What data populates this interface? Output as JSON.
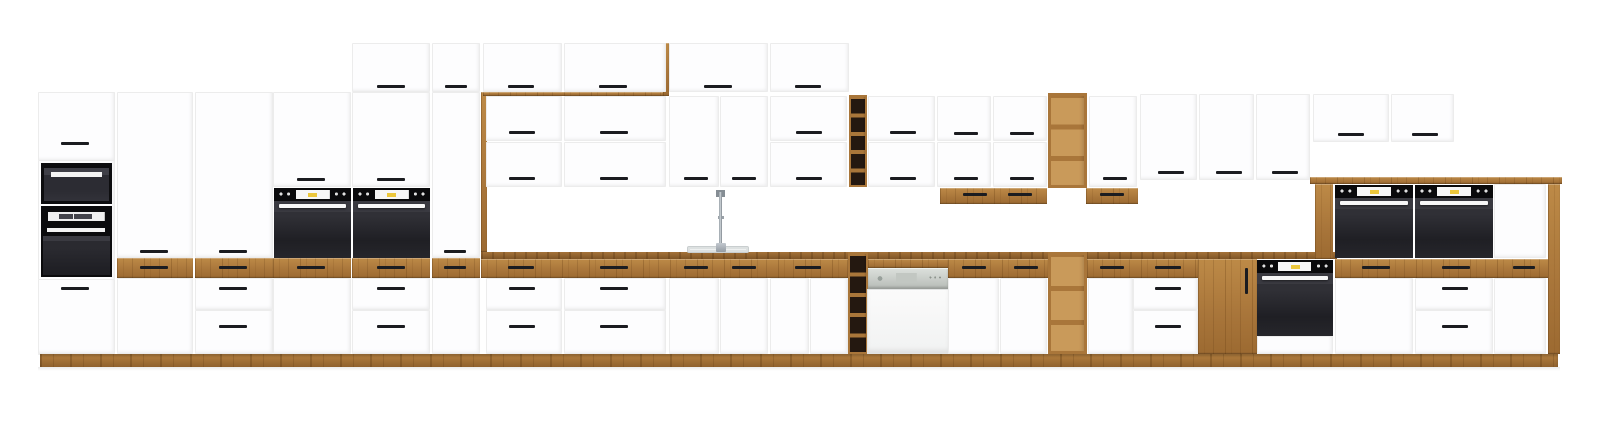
{
  "scene": {
    "width": 1600,
    "height": 434,
    "background": "#ffffff",
    "colors": {
      "cabinet_white": "#fdfdfe",
      "oak_wood": "#b07c3d",
      "oak_dark": "#7f5526",
      "handle_black": "#1b1c20",
      "oven_black": "#1f1f24",
      "accent_yellow": "#ecc73c",
      "dishwasher_gray": "#c7cbc7",
      "sink_gray": "#eff1f1"
    },
    "elements": [
      [
        "door",
        "tall-column-a-frame",
        38,
        92,
        77,
        263
      ],
      [
        "door",
        "tall-column-a-door-top",
        38,
        92,
        77,
        69
      ],
      [
        "h",
        "handle",
        61,
        142,
        28,
        3
      ],
      [
        "micro",
        "built-in-microwave",
        41,
        163,
        71,
        41
      ],
      [
        "oven-a",
        "built-in-oven-tall-column",
        41,
        206,
        71,
        71
      ],
      [
        "door",
        "tall-column-a-door-bottom",
        38,
        279,
        77,
        75
      ],
      [
        "h",
        "handle",
        61,
        287,
        28,
        3
      ],
      [
        "door",
        "tall-column-b-door",
        117,
        92,
        76,
        166
      ],
      [
        "h",
        "handle",
        140,
        250,
        28,
        3
      ],
      [
        "wood",
        "oak-drawer-front",
        117,
        258,
        76,
        20
      ],
      [
        "h",
        "handle",
        140,
        266,
        28,
        3
      ],
      [
        "door",
        "tall-column-b-base-panel",
        117,
        278,
        76,
        76
      ],
      [
        "door",
        "tall-column-c-door",
        195,
        92,
        78,
        166
      ],
      [
        "h",
        "handle",
        219,
        250,
        28,
        3
      ],
      [
        "wood",
        "oak-drawer-front",
        195,
        258,
        78,
        20
      ],
      [
        "h",
        "handle",
        219,
        266,
        28,
        3
      ],
      [
        "drawer",
        "drawer-front",
        195,
        278,
        78,
        32
      ],
      [
        "h",
        "handle",
        219,
        287,
        28,
        3
      ],
      [
        "drawer",
        "drawer-front",
        195,
        310,
        78,
        44
      ],
      [
        "h",
        "handle",
        219,
        325,
        28,
        3
      ],
      [
        "door",
        "oven-housing-d-door",
        273,
        92,
        78,
        95
      ],
      [
        "h",
        "handle",
        297,
        178,
        28,
        3
      ],
      [
        "oven",
        "built-in-oven-1",
        274,
        188,
        77,
        70
      ],
      [
        "wood",
        "oak-drawer-front",
        273,
        258,
        78,
        20
      ],
      [
        "h",
        "handle",
        297,
        266,
        28,
        3
      ],
      [
        "door",
        "oven-housing-d-base-door",
        273,
        278,
        78,
        76
      ],
      [
        "door",
        "oven-housing-e-top-door",
        352,
        43,
        78,
        49
      ],
      [
        "h",
        "handle",
        377,
        85,
        28,
        3
      ],
      [
        "door",
        "oven-housing-e-door",
        352,
        92,
        78,
        95
      ],
      [
        "h",
        "handle",
        377,
        178,
        28,
        3
      ],
      [
        "oven",
        "built-in-oven-2",
        353,
        188,
        77,
        70
      ],
      [
        "wood",
        "oak-drawer-front",
        352,
        258,
        78,
        20
      ],
      [
        "h",
        "handle",
        377,
        266,
        28,
        3
      ],
      [
        "drawer",
        "drawer-front",
        352,
        278,
        78,
        32
      ],
      [
        "h",
        "handle",
        377,
        287,
        28,
        3
      ],
      [
        "drawer",
        "drawer-front",
        352,
        310,
        78,
        44
      ],
      [
        "h",
        "handle",
        377,
        325,
        28,
        3
      ],
      [
        "door",
        "pantry-top-door",
        432,
        43,
        48,
        49
      ],
      [
        "h",
        "handle",
        445,
        85,
        22,
        3
      ],
      [
        "door",
        "pantry-tall-door",
        432,
        92,
        48,
        166
      ],
      [
        "h",
        "handle",
        444,
        250,
        22,
        3
      ],
      [
        "wood",
        "oak-drawer-front",
        432,
        258,
        48,
        20
      ],
      [
        "h",
        "handle",
        444,
        266,
        22,
        3
      ],
      [
        "door",
        "pantry-base-door",
        432,
        278,
        48,
        76
      ],
      [
        "wood",
        "oak-frame-left-post",
        481,
        92,
        6,
        160
      ],
      [
        "wood",
        "oak-frame-top-rail",
        483,
        92,
        180,
        4
      ],
      [
        "wood",
        "oak-frame-right-post",
        663,
        43,
        6,
        53
      ],
      [
        "door",
        "top-row-door",
        483,
        43,
        79,
        49
      ],
      [
        "h",
        "handle",
        508,
        85,
        26,
        3
      ],
      [
        "door",
        "top-row-door",
        564,
        43,
        102,
        49
      ],
      [
        "h",
        "handle",
        599,
        85,
        28,
        3
      ],
      [
        "door",
        "top-row-door",
        669,
        43,
        99,
        49
      ],
      [
        "h",
        "handle",
        704,
        85,
        28,
        3
      ],
      [
        "door",
        "top-row-door",
        770,
        43,
        79,
        49
      ],
      [
        "h",
        "handle",
        795,
        85,
        26,
        3
      ],
      [
        "door",
        "upper-cabinet-door",
        486,
        96,
        76,
        45
      ],
      [
        "h",
        "handle",
        509,
        131,
        26,
        3
      ],
      [
        "door",
        "upper-cabinet-door",
        486,
        142,
        76,
        45
      ],
      [
        "h",
        "handle",
        509,
        177,
        26,
        3
      ],
      [
        "door",
        "upper-cabinet-door",
        564,
        96,
        102,
        45
      ],
      [
        "h",
        "handle",
        600,
        131,
        28,
        3
      ],
      [
        "door",
        "upper-cabinet-door",
        564,
        142,
        102,
        45
      ],
      [
        "h",
        "handle",
        600,
        177,
        28,
        3
      ],
      [
        "door",
        "upper-cabinet-door",
        669,
        96,
        50,
        91
      ],
      [
        "h",
        "handle",
        684,
        177,
        24,
        3
      ],
      [
        "door",
        "upper-cabinet-door",
        720,
        96,
        48,
        91
      ],
      [
        "h",
        "handle",
        732,
        177,
        24,
        3
      ],
      [
        "door",
        "upper-cabinet-door",
        770,
        96,
        77,
        45
      ],
      [
        "h",
        "handle",
        796,
        131,
        26,
        3
      ],
      [
        "door",
        "upper-cabinet-door",
        770,
        142,
        77,
        45
      ],
      [
        "h",
        "handle",
        796,
        177,
        26,
        3
      ],
      [
        "wine",
        "wine-rack-upper",
        849,
        95,
        18,
        92
      ],
      [
        "door",
        "upper-cabinet-door",
        868,
        96,
        67,
        45
      ],
      [
        "h",
        "handle",
        890,
        131,
        26,
        3
      ],
      [
        "door",
        "upper-cabinet-door",
        868,
        142,
        67,
        45
      ],
      [
        "h",
        "handle",
        890,
        177,
        26,
        3
      ],
      [
        "door",
        "upper-cabinet-door",
        937,
        96,
        54,
        45
      ],
      [
        "h",
        "handle",
        954,
        132,
        24,
        3
      ],
      [
        "door",
        "upper-cabinet-door",
        937,
        142,
        54,
        45
      ],
      [
        "h",
        "handle",
        954,
        177,
        24,
        3
      ],
      [
        "door",
        "upper-cabinet-door",
        993,
        96,
        54,
        45
      ],
      [
        "h",
        "handle",
        1010,
        132,
        24,
        3
      ],
      [
        "door",
        "upper-cabinet-door",
        993,
        142,
        54,
        45
      ],
      [
        "h",
        "handle",
        1010,
        177,
        24,
        3
      ],
      [
        "wood",
        "oak-under-cabinet-drawers",
        940,
        188,
        107,
        16
      ],
      [
        "h",
        "handle",
        963,
        193,
        24,
        3
      ],
      [
        "h",
        "handle",
        1008,
        193,
        24,
        3
      ],
      [
        "shelf",
        "open-shelf-upper",
        1048,
        93,
        39,
        95
      ],
      [
        "door",
        "upper-cabinet-door",
        1089,
        96,
        48,
        91
      ],
      [
        "h",
        "handle",
        1103,
        177,
        24,
        3
      ],
      [
        "wood",
        "oak-under-cabinet-drawer",
        1086,
        188,
        52,
        16
      ],
      [
        "h",
        "handle",
        1100,
        193,
        24,
        3
      ],
      [
        "door",
        "upper-cabinet-door",
        1140,
        94,
        57,
        86
      ],
      [
        "h",
        "handle",
        1158,
        171,
        26,
        3
      ],
      [
        "door",
        "upper-cabinet-door",
        1199,
        94,
        55,
        86
      ],
      [
        "h",
        "handle",
        1216,
        171,
        26,
        3
      ],
      [
        "door",
        "upper-cabinet-door",
        1256,
        94,
        54,
        86
      ],
      [
        "h",
        "handle",
        1272,
        171,
        26,
        3
      ],
      [
        "door",
        "upper-cabinet-door-short",
        1313,
        94,
        76,
        48
      ],
      [
        "h",
        "handle",
        1338,
        133,
        26,
        3
      ],
      [
        "door",
        "upper-cabinet-door-short",
        1391,
        94,
        63,
        48
      ],
      [
        "h",
        "handle",
        1412,
        133,
        26,
        3
      ],
      [
        "wood-edge",
        "countertop-edge",
        481,
        252,
        856,
        7
      ],
      [
        "sink",
        "sink-basin",
        687,
        246,
        62,
        7
      ],
      [
        "faucet",
        "kitchen-faucet",
        712,
        190,
        18,
        62
      ],
      [
        "wood",
        "oak-drawer-band",
        481,
        259,
        367,
        19
      ],
      [
        "h",
        "handle",
        508,
        266,
        26,
        3
      ],
      [
        "h",
        "handle",
        600,
        266,
        28,
        3
      ],
      [
        "h",
        "handle",
        684,
        266,
        24,
        3
      ],
      [
        "h",
        "handle",
        732,
        266,
        24,
        3
      ],
      [
        "h",
        "handle",
        795,
        266,
        26,
        3
      ],
      [
        "wine-b",
        "wine-rack-base",
        848,
        252,
        20,
        102
      ],
      [
        "wood",
        "oak-drawer-band",
        868,
        259,
        80,
        9
      ],
      [
        "dw-panel",
        "dishwasher-control-panel",
        868,
        268,
        80,
        21
      ],
      [
        "dw-body",
        "dishwasher-door",
        867,
        289,
        82,
        65
      ],
      [
        "wood",
        "oak-drawer-band",
        948,
        259,
        100,
        19
      ],
      [
        "h",
        "handle",
        962,
        266,
        24,
        3
      ],
      [
        "h",
        "handle",
        1014,
        266,
        24,
        3
      ],
      [
        "shelf-b",
        "open-shelf-base",
        1048,
        252,
        39,
        102
      ],
      [
        "wood",
        "oak-drawer-band",
        1087,
        259,
        111,
        19
      ],
      [
        "h",
        "handle",
        1100,
        266,
        24,
        3
      ],
      [
        "h",
        "handle",
        1155,
        266,
        26,
        3
      ],
      [
        "wood",
        "oak-front-cabinet",
        1198,
        259,
        59,
        95
      ],
      [
        "vh",
        "vertical-handle",
        1245,
        268,
        3,
        26
      ],
      [
        "oven",
        "built-in-oven-base",
        1257,
        260,
        76,
        76
      ],
      [
        "door",
        "oven-base-drawer",
        1257,
        336,
        76,
        18
      ],
      [
        "drawer",
        "drawer-front",
        486,
        278,
        76,
        32
      ],
      [
        "h",
        "handle",
        509,
        287,
        26,
        3
      ],
      [
        "drawer",
        "drawer-front",
        486,
        310,
        76,
        44
      ],
      [
        "h",
        "handle",
        509,
        325,
        26,
        3
      ],
      [
        "drawer",
        "drawer-front",
        564,
        278,
        102,
        32
      ],
      [
        "h",
        "handle",
        600,
        287,
        28,
        3
      ],
      [
        "drawer",
        "drawer-front",
        564,
        310,
        102,
        44
      ],
      [
        "h",
        "handle",
        600,
        325,
        28,
        3
      ],
      [
        "door",
        "sink-base-door",
        669,
        278,
        50,
        76
      ],
      [
        "door",
        "sink-base-door",
        720,
        278,
        48,
        76
      ],
      [
        "door",
        "base-cabinet-door",
        770,
        278,
        39,
        76
      ],
      [
        "door",
        "base-cabinet-door",
        810,
        278,
        38,
        76
      ],
      [
        "door",
        "base-cabinet-door",
        948,
        278,
        51,
        76
      ],
      [
        "door",
        "base-cabinet-door",
        1000,
        278,
        47,
        76
      ],
      [
        "door",
        "base-cabinet-door",
        1088,
        278,
        45,
        76
      ],
      [
        "drawer",
        "drawer-front",
        1133,
        278,
        65,
        32
      ],
      [
        "h",
        "handle",
        1155,
        287,
        26,
        3
      ],
      [
        "drawer",
        "drawer-front",
        1133,
        310,
        65,
        44
      ],
      [
        "h",
        "handle",
        1155,
        325,
        26,
        3
      ],
      [
        "wood",
        "raised-block-countertop",
        1310,
        177,
        252,
        7
      ],
      [
        "wood",
        "raised-block-side-panel",
        1315,
        184,
        18,
        75
      ],
      [
        "oven",
        "built-in-oven-3",
        1335,
        185,
        78,
        73
      ],
      [
        "oven",
        "built-in-oven-4",
        1415,
        185,
        78,
        73
      ],
      [
        "door",
        "raised-block-door",
        1494,
        184,
        52,
        74
      ],
      [
        "wood",
        "oak-drawer-band",
        1335,
        259,
        225,
        19
      ],
      [
        "h",
        "handle",
        1362,
        266,
        28,
        3
      ],
      [
        "h",
        "handle",
        1442,
        266,
        28,
        3
      ],
      [
        "h",
        "handle",
        1513,
        266,
        22,
        3
      ],
      [
        "door",
        "raised-block-base-door",
        1335,
        278,
        78,
        76
      ],
      [
        "drawer",
        "drawer-front",
        1415,
        278,
        78,
        32
      ],
      [
        "h",
        "handle",
        1442,
        287,
        26,
        3
      ],
      [
        "drawer",
        "drawer-front",
        1415,
        310,
        78,
        44
      ],
      [
        "h",
        "handle",
        1442,
        325,
        26,
        3
      ],
      [
        "door",
        "raised-block-base-door",
        1494,
        278,
        52,
        76
      ],
      [
        "wood",
        "raised-block-side-panel",
        1548,
        184,
        12,
        170
      ],
      [
        "plinth",
        "oak-plinth",
        40,
        354,
        1518,
        13
      ],
      [
        "shadow",
        "floor-shadow",
        38,
        367,
        1522,
        4
      ]
    ]
  }
}
